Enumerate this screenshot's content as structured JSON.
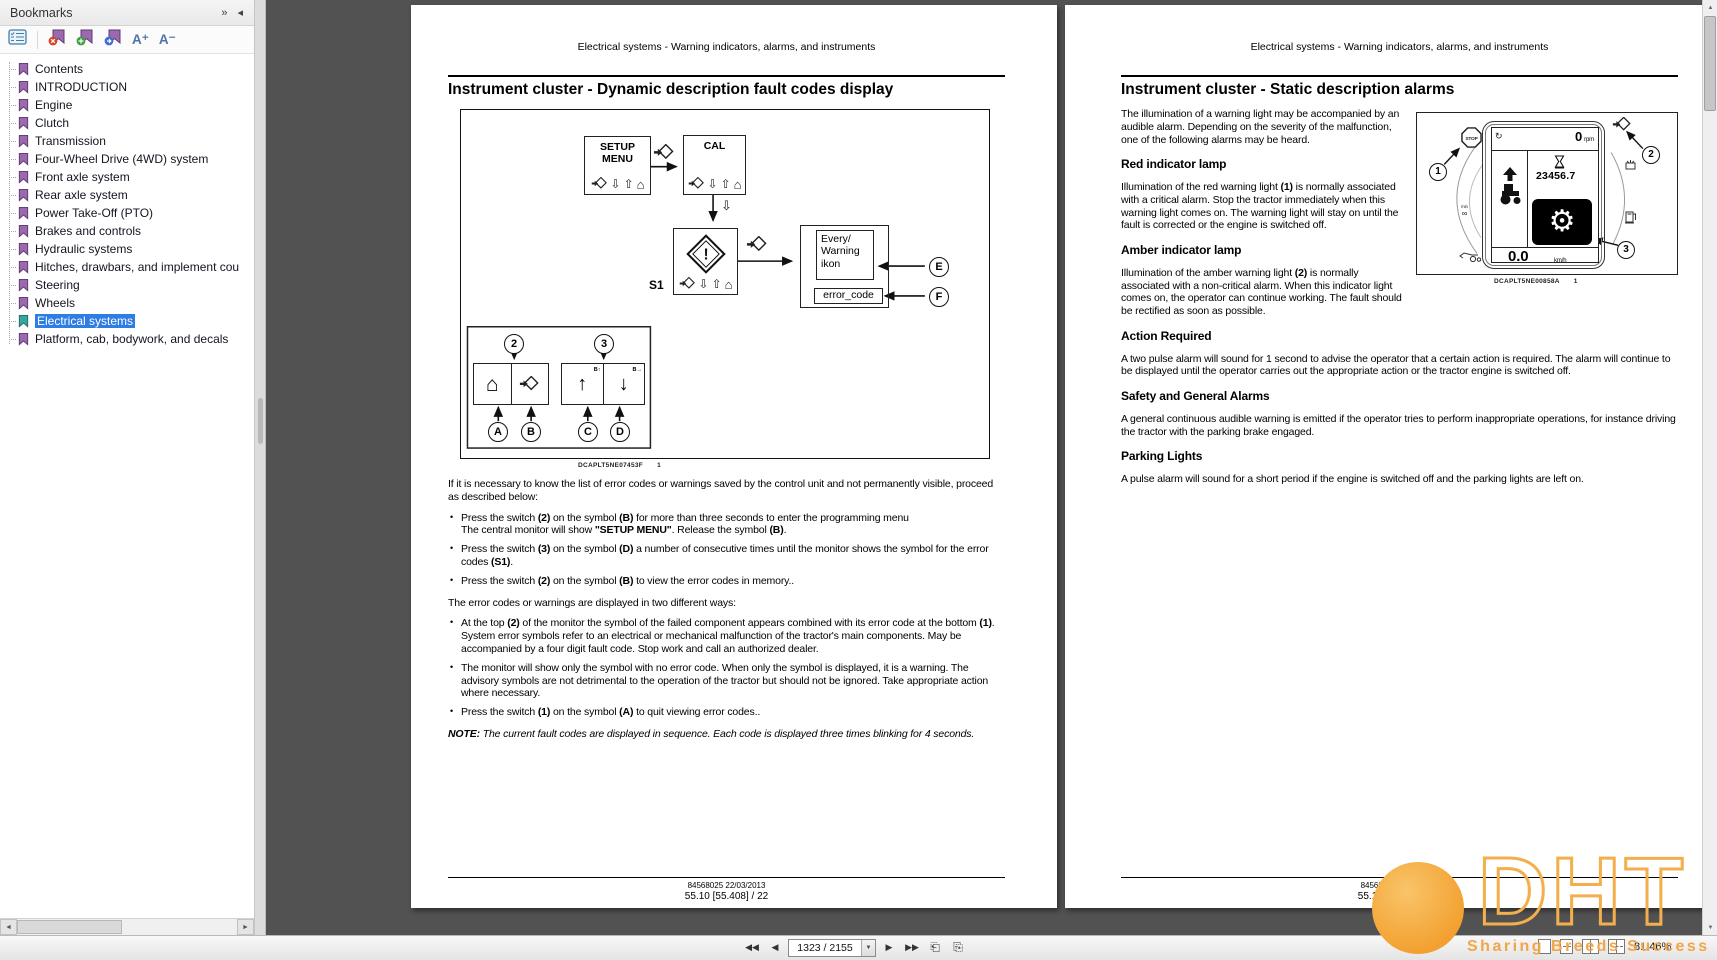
{
  "bookmarks_panel": {
    "title": "Bookmarks",
    "header_icons": [
      "expand-options-icon",
      "collapse-panel-icon"
    ],
    "toolbar_icons": [
      "options-icon",
      "delete-bookmark-icon",
      "new-bookmark-icon",
      "go-to-bookmark-icon"
    ],
    "text_size": {
      "increase": "A⁺",
      "decrease": "A⁻"
    },
    "items": [
      {
        "label": "Contents",
        "selected": false
      },
      {
        "label": "INTRODUCTION",
        "selected": false
      },
      {
        "label": "Engine",
        "selected": false
      },
      {
        "label": "Clutch",
        "selected": false
      },
      {
        "label": "Transmission",
        "selected": false
      },
      {
        "label": "Four-Wheel Drive (4WD) system",
        "selected": false
      },
      {
        "label": "Front axle system",
        "selected": false
      },
      {
        "label": "Rear axle system",
        "selected": false
      },
      {
        "label": "Power Take-Off (PTO)",
        "selected": false
      },
      {
        "label": "Brakes and controls",
        "selected": false
      },
      {
        "label": "Hydraulic systems",
        "selected": false
      },
      {
        "label": "Hitches, drawbars, and implement cou",
        "selected": false
      },
      {
        "label": "Steering",
        "selected": false
      },
      {
        "label": "Wheels",
        "selected": false
      },
      {
        "label": "Electrical systems",
        "selected": true
      },
      {
        "label": "Platform, cab, bodywork, and decals",
        "selected": false
      }
    ]
  },
  "left_page": {
    "header": "Electrical systems - Warning indicators, alarms, and instruments",
    "title": "Instrument cluster - Dynamic description fault codes display",
    "figure": {
      "setup_box": "SETUP\nMENU",
      "cal_box": "CAL",
      "s1_label": "S1",
      "every_warning_box": "Every/\nWarning\nikon",
      "error_code_box": "error_code",
      "cell_c_tag": "B↑",
      "cell_d_tag": "B→",
      "callouts": [
        "2",
        "3",
        "A",
        "B",
        "C",
        "D",
        "E",
        "F"
      ],
      "icons": [
        "select-diamond-icon",
        "arrow-down-icon",
        "arrow-up-icon",
        "home-icon",
        "warning-diamond-icon"
      ],
      "caption": "DCAPLT5NE07453F",
      "caption_index": "1"
    },
    "intro": "If it is necessary to know the list of error codes or warnings saved by the control unit and not permanently visible, proceed as described below:",
    "bullets1": [
      "Press the switch **(2)** on the symbol **(B)** for more than three seconds to enter the programming menu\nThe central monitor will show **\"SETUP MENU\"**.  Release the symbol **(B)**.",
      "Press the switch **(3)** on the symbol **(D)** a number of consecutive times until the monitor shows the symbol for the error codes **(S1)**.",
      "Press the switch **(2)** on the symbol **(B)** to view the error codes in memory.."
    ],
    "middle": "The error codes or warnings are displayed in two different ways:",
    "bullets2": [
      "At the top **(2)** of the monitor the symbol of the failed component appears combined with its error code at the bottom **(1)**.  System error symbols refer to an electrical or mechanical malfunction of the tractor's main components.  May be accompanied by a four digit fault code.  Stop work and call an authorized dealer.",
      "The monitor will show only the symbol with no error code.  When only the symbol is displayed, it is a warning.  The advisory symbols are not detrimental to the operation of the tractor but should not be ignored.  Take appropriate action where necessary.",
      "Press the switch **(1)** on the symbol **(A)** to quit viewing error codes.."
    ],
    "note": "**NOTE:** The current fault codes are displayed in sequence.  Each code is displayed three times blinking for 4 seconds.",
    "footer_line1": "84568025 22/03/2013",
    "footer_line2": "55.10 [55.408] / 22"
  },
  "right_page": {
    "header": "Electrical systems - Warning indicators, alarms, and instruments",
    "title": "Instrument cluster - Static description alarms",
    "intro": "The illumination of a warning light may be accompanied by an audible alarm.  Depending on the severity of the malfunction, one of the following alarms may be heard.",
    "sections": [
      {
        "heading": "Red indicator lamp",
        "body": "Illumination of the red warning light **(1)** is normally associated with a critical alarm.  Stop the tractor immediately when this warning light comes on.  The warning light will stay on until the fault is corrected or the engine is switched off."
      },
      {
        "heading": "Amber indicator lamp",
        "body": "Illumination of the amber warning light **(2)** is normally associated with a non-critical alarm.  When this indicator light comes on, the operator can continue working.  The fault should be rectified as soon as possible."
      },
      {
        "heading": "Action Required",
        "body": "A two pulse alarm will sound for 1 second to advise the operator that a certain action is required.  The alarm will continue to be displayed until the operator carries out the appropriate action or the tractor engine is switched off."
      },
      {
        "heading": "Safety and General Alarms",
        "body": "A general continuous audible warning is emitted if the operator tries to perform inappropriate operations, for instance driving the tractor with the parking brake engaged."
      },
      {
        "heading": "Parking Lights",
        "body": "A pulse alarm will sound for a short period if the engine is switched off and the parking lights are left on."
      }
    ],
    "figure": {
      "rpm_value": "0",
      "rpm_unit": "rpm",
      "hours_value": "23456.7",
      "speed_value": "0.0",
      "speed_unit": "km/h",
      "callouts": [
        "1",
        "2",
        "3"
      ],
      "icons": [
        "stop-sign-icon",
        "rotation-icon",
        "hourglass-icon",
        "gear-oil-icon",
        "tractor-icon",
        "hourmeter-icon",
        "front-loader-icon",
        "select-diamond-icon",
        "brake-icon",
        "fuel-pump-icon"
      ],
      "caption": "DCAPLT5NE00858A",
      "caption_index": "1"
    },
    "footer_line1": "84568025 22/03/2013",
    "footer_line2": "55.10 [55.408] / 23"
  },
  "bottom_toolbar": {
    "nav_icons": [
      "first-page-icon",
      "previous-page-icon",
      "next-page-icon",
      "last-page-icon",
      "previous-view-icon",
      "next-view-icon"
    ],
    "page_field_value": "1323 / 2155",
    "view_mode_icons": [
      "single-page-icon",
      "continuous-scroll-icon",
      "two-page-icon",
      "two-page-scroll-icon"
    ],
    "zoom_level": "81.46%"
  },
  "watermark": {
    "brand": "DHT",
    "tagline": "Sharing Breeds Success"
  }
}
